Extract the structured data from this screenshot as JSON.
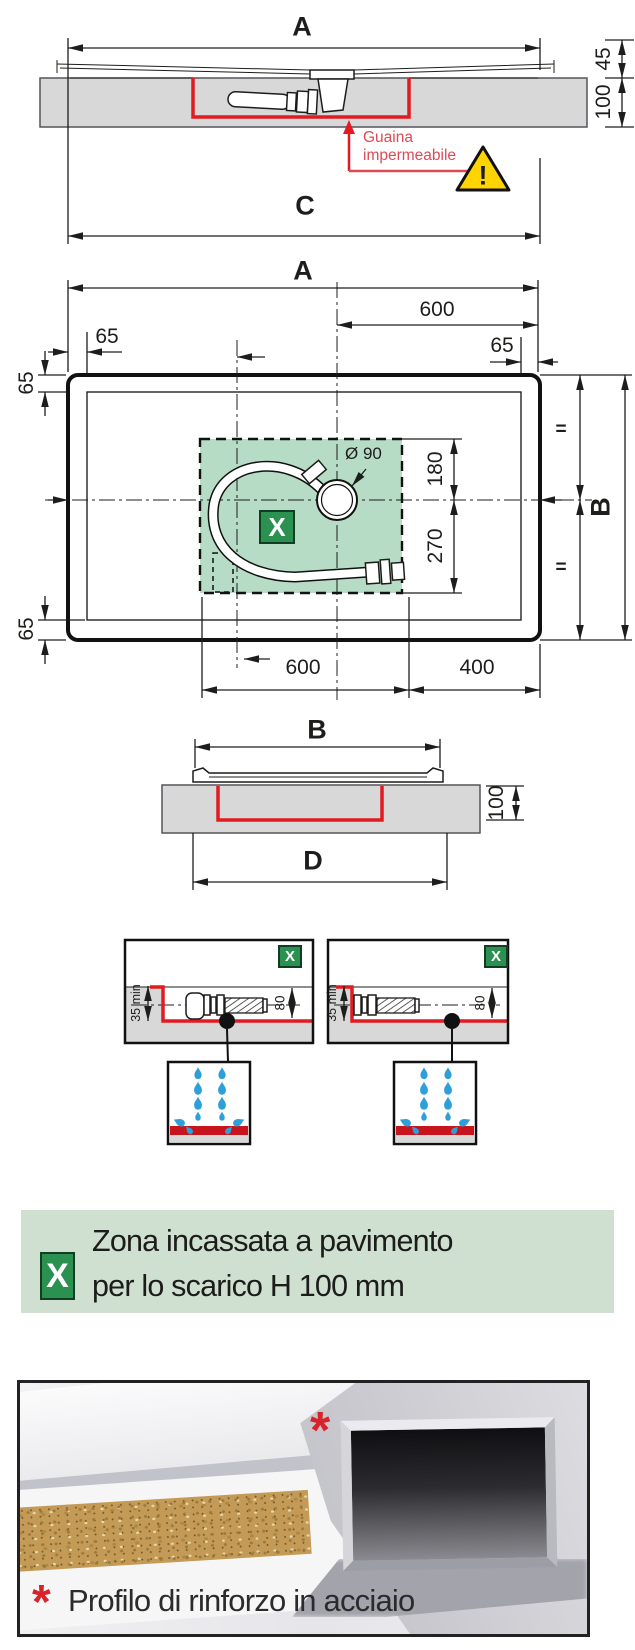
{
  "colors": {
    "ink": "#1d1d1b",
    "red": "#e11b22",
    "label_red": "#dd4a55",
    "zone_green": "#b7dcc6",
    "badge_green": "#2a9150",
    "banner_green": "#cfe0d0",
    "slab_gray": "#d8d8d8",
    "drop_blue": "#2d9fd9",
    "warning_yellow": "#ffd400",
    "bar_red": "#c8141c"
  },
  "section_top": {
    "dim_a": "A",
    "dim_45": "45",
    "dim_100": "100",
    "dim_c": "C",
    "membrane_label_1": "Guaina",
    "membrane_label_2": "impermeabile",
    "warning_mark": "!"
  },
  "plan": {
    "dim_a": "A",
    "dim_600_top": "600",
    "dim_65_top_left": "65",
    "dim_65_top_right": "65",
    "dim_65_left": "65",
    "dim_65_bottom_left": "65",
    "drain_diameter": "Ø 90",
    "dim_180": "180",
    "dim_270": "270",
    "dim_b": "B",
    "eq_top": "=",
    "eq_bottom": "=",
    "dim_600_bottom": "600",
    "dim_400_bottom": "400",
    "zone_badge": "X"
  },
  "section_b": {
    "dim_b": "B",
    "dim_100": "100",
    "dim_d": "D"
  },
  "details": [
    {
      "badge": "X",
      "min_height": "35 min",
      "pipe_height": "80"
    },
    {
      "badge": "X",
      "min_height": "35 min",
      "pipe_height": "80"
    }
  ],
  "legend": {
    "badge": "X",
    "line1": "Zona incassata a pavimento",
    "line2": "per lo scarico H 100 mm"
  },
  "photo": {
    "marker": "*",
    "caption_marker": "*",
    "caption": "Profilo di rinforzo in acciaio"
  }
}
